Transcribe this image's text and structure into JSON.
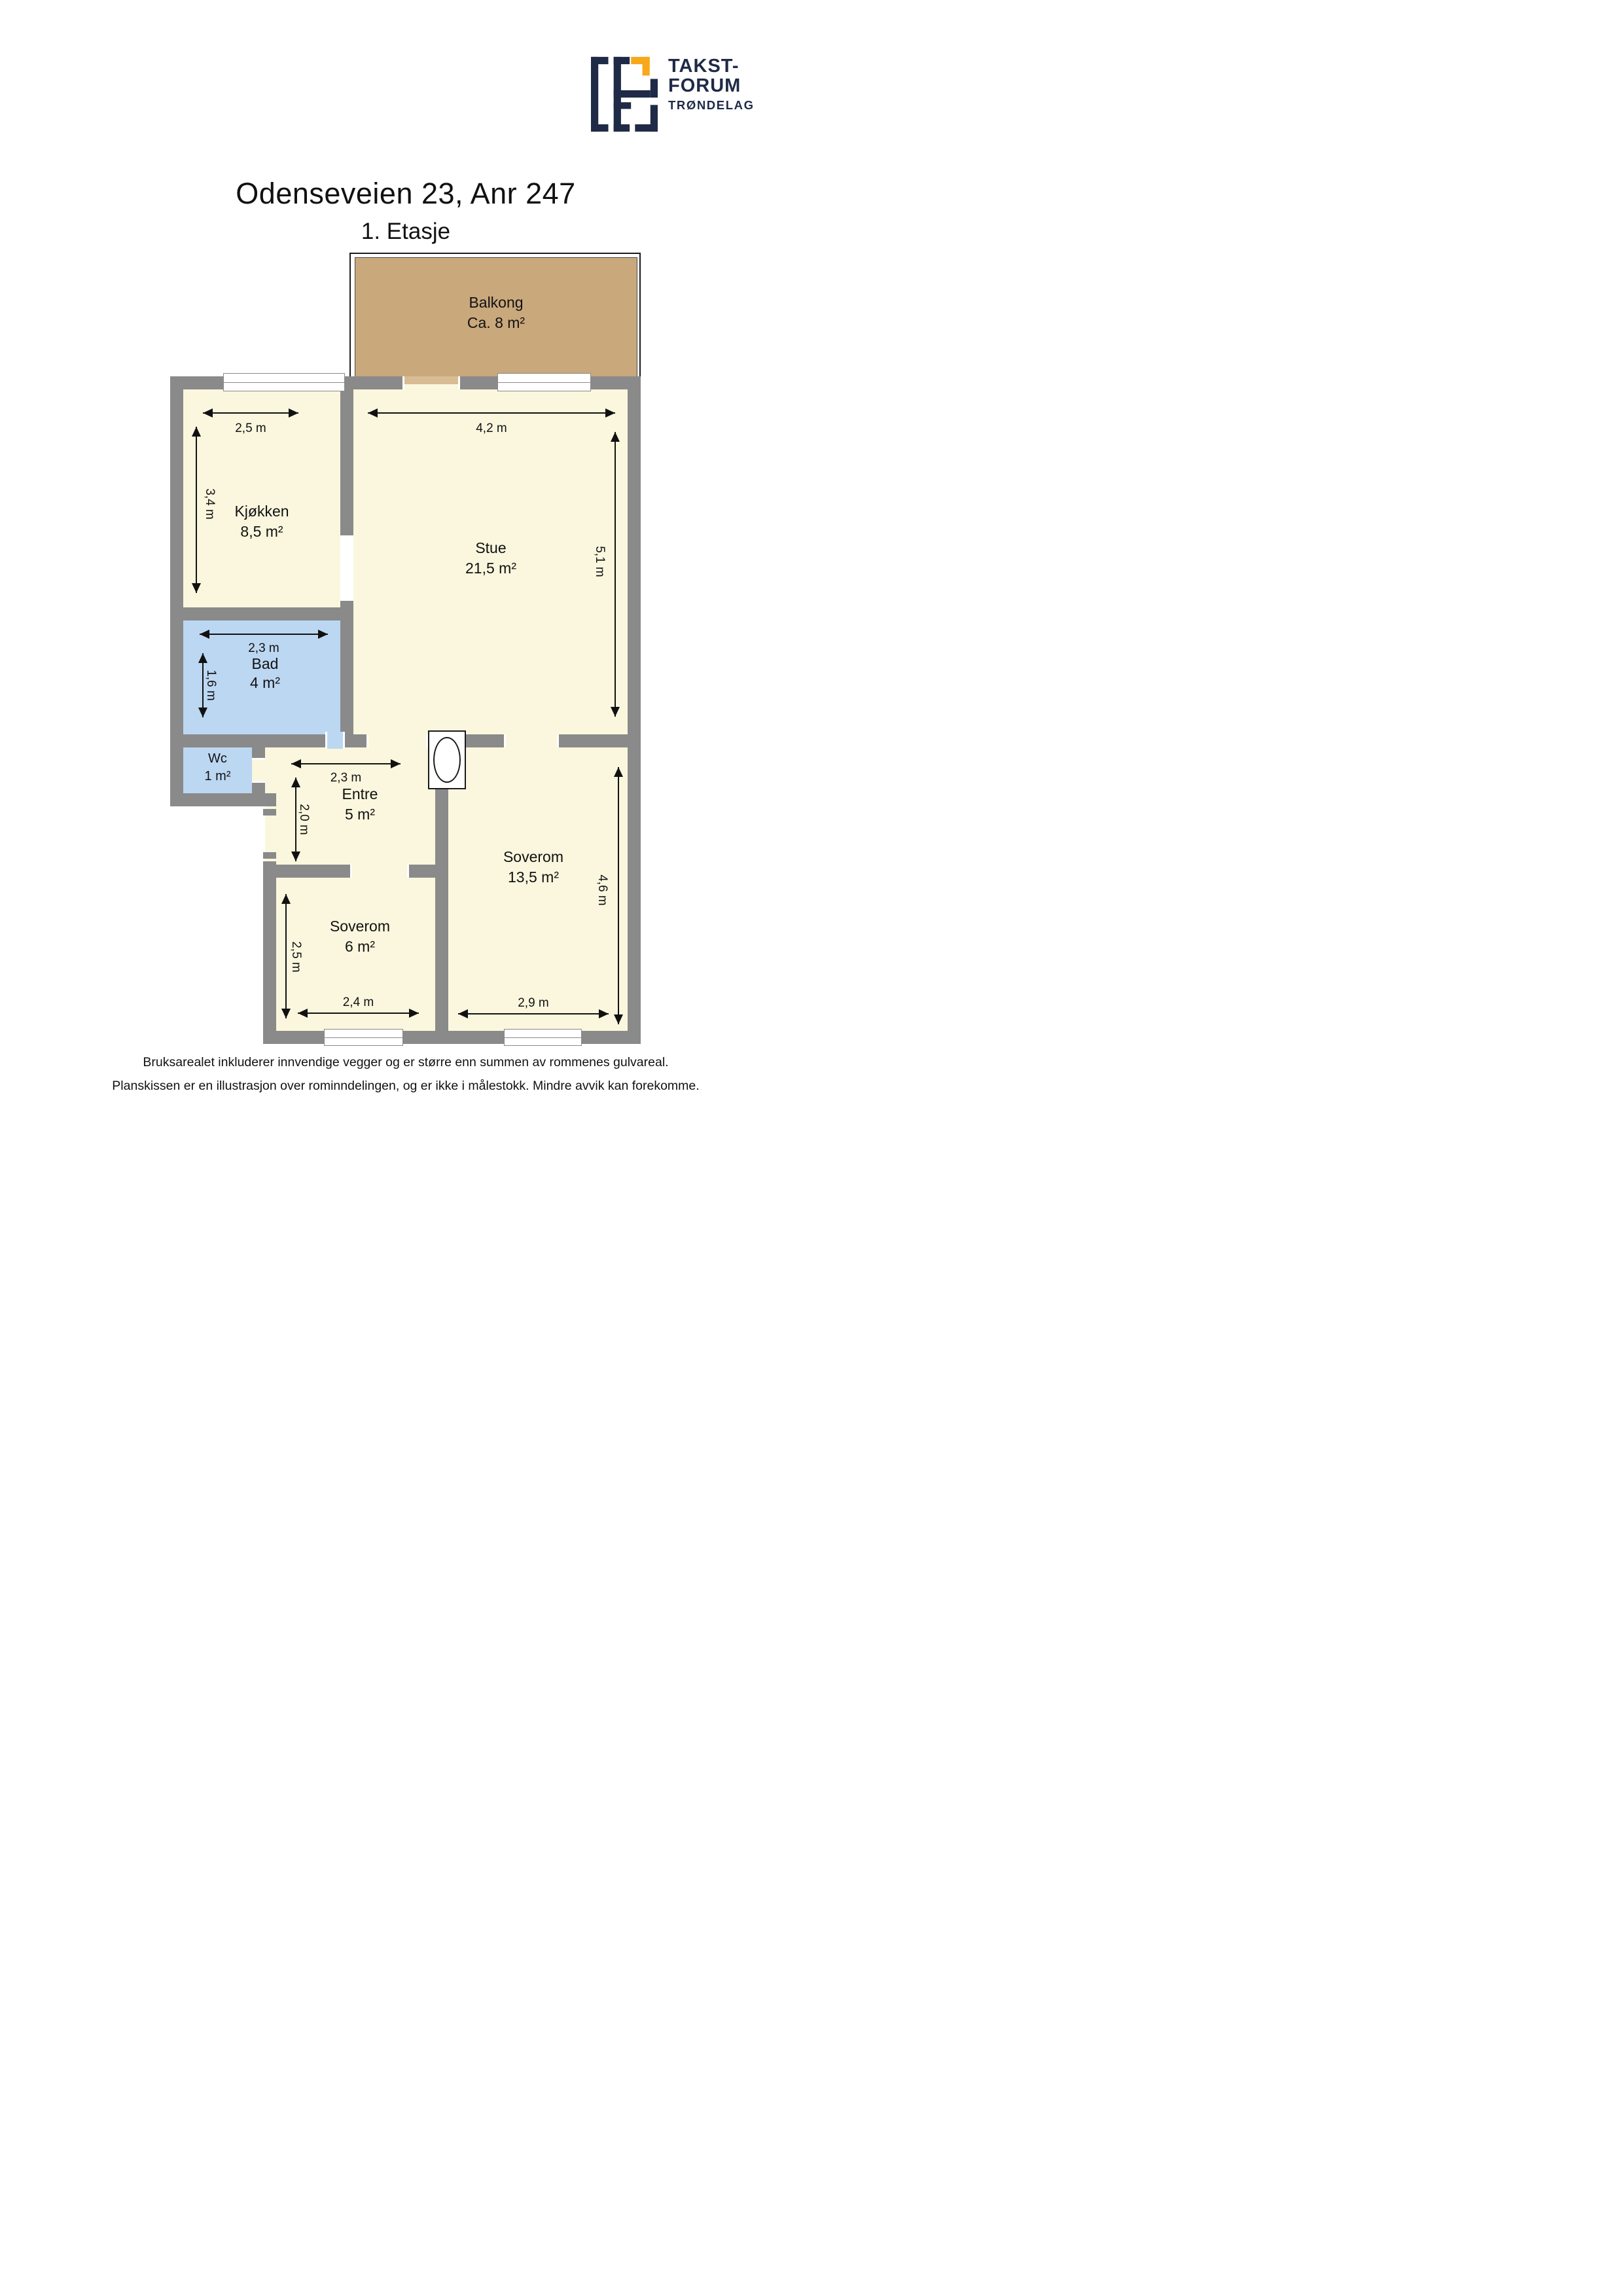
{
  "logo": {
    "line1": "TAKST-",
    "line2": "FORUM",
    "line3": "TRØNDELAG"
  },
  "title": "Odenseveien 23, Anr 247",
  "subtitle": "1. Etasje",
  "colors": {
    "wall": "#8a8a8a",
    "floor": "#faf7de",
    "wet_room": "#bcd7f2",
    "balcony": "#c9a87c",
    "balcony_door": "#d8bc93",
    "logo_navy": "#1f2a47",
    "logo_orange": "#f7a81b"
  },
  "plan": {
    "balcony": {
      "name": "Balkong",
      "area": "Ca. 8 m²"
    },
    "rooms": [
      {
        "id": "kjokken",
        "name": "Kjøkken",
        "area": "8,5 m²",
        "width": "2,5 m",
        "height": "3,4 m"
      },
      {
        "id": "stue",
        "name": "Stue",
        "area": "21,5 m²",
        "width": "4,2 m",
        "height": "5,1 m"
      },
      {
        "id": "bad",
        "name": "Bad",
        "area": "4 m²",
        "width": "2,3 m",
        "height": "1,6 m"
      },
      {
        "id": "wc",
        "name": "Wc",
        "area": "1 m²"
      },
      {
        "id": "entre",
        "name": "Entre",
        "area": "5 m²",
        "width": "2,3 m",
        "height": "2,0 m"
      },
      {
        "id": "soverom-stor",
        "name": "Soverom",
        "area": "13,5 m²",
        "width": "2,9 m",
        "height": "4,6 m"
      },
      {
        "id": "soverom-liten",
        "name": "Soverom",
        "area": "6 m²",
        "width": "2,4 m",
        "height": "2,5 m"
      }
    ]
  },
  "footer": {
    "line1": "Bruksarealet inkluderer innvendige vegger og er større enn summen av rommenes gulvareal.",
    "line2": "Planskissen er en illustrasjon over rominndelingen, og er ikke i målestokk. Mindre avvik kan forekomme."
  }
}
